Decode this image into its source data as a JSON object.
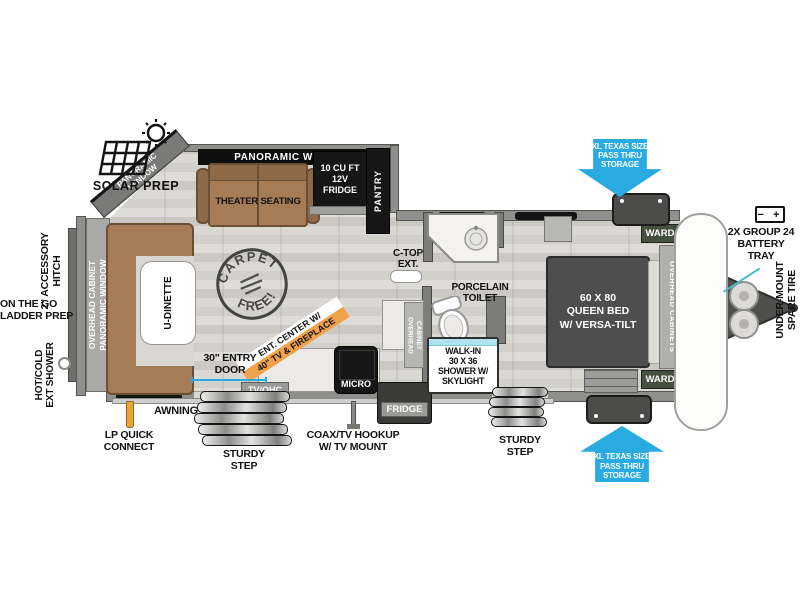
{
  "exterior_left": {
    "solar_prep": "SOLAR PREP",
    "accessory_hitch": "2\" ACCESSORY\nHITCH",
    "ladder_prep": "ON THE GO\nLADDER PREP",
    "ext_shower": "HOT/COLD\nEXT SHOWER",
    "lp_quick_connect": "LP QUICK\nCONNECT",
    "awning": "AWNING"
  },
  "rear_band": "OVERHEAD CABINET\nPANORAMIC WINDOW",
  "dinette": {
    "label": "U-DINETTE"
  },
  "slide_out": {
    "panoramic_corner": "PANORAMIC\nWINDOW",
    "panoramic_top": "PANORAMIC WINDOW",
    "theater_seating": "THEATER SEATING",
    "fridge_12v": "10 CU FT\n12V\nFRIDGE",
    "pantry": "PANTRY"
  },
  "stamp": {
    "top": "CARPET",
    "bottom": "FREE!"
  },
  "kitchen": {
    "ent_center_line1": "ENT. CENTER W/",
    "ent_center_line2": "40\" TV & FIREPLACE",
    "micro": "MICRO",
    "tv_ohc": "TV/OHC",
    "overhead_cabinet": "OVERHEAD\nCABINET",
    "fridge_tag": "FRIDGE",
    "coax_hookup": "COAX/TV HOOKUP\nW/ TV MOUNT"
  },
  "bath": {
    "c_top_ext": "C-TOP\nEXT.",
    "porcelain_toilet": "PORCELAIN\nTOILET",
    "shower": "WALK-IN\n30 X 36\nSHOWER W/\nSKYLIGHT"
  },
  "bedroom": {
    "queen_bed": "60 X 80\nQUEEN BED\nW/ VERSA-TILT",
    "ward_top": "WARD",
    "ward_bottom": "WARD",
    "overhead_cabinets": "OVERHEAD CABINETS"
  },
  "doors": {
    "entry_door": "30\" ENTRY\nDOOR",
    "sturdy_step_1": "STURDY\nSTEP",
    "sturdy_step_2": "STURDY\nSTEP"
  },
  "storage": {
    "top_arrow": "XL TEXAS SIZE\nPASS THRU\nSTORAGE",
    "bottom_arrow": "XL TEXAS SIZE\nPASS THRU\nSTORAGE"
  },
  "front": {
    "battery_icon": "−  +",
    "battery_tray": "2X GROUP 24\nBATTERY\nTRAY",
    "spare_tire": "UNDER-MOUNT\nSPARE TIRE"
  },
  "colors": {
    "arrow_blue": "#29abe2",
    "banner_orange": "#f0a24a",
    "sofa_brown": "#a57c55",
    "bed_gray": "#4e4e4e"
  }
}
